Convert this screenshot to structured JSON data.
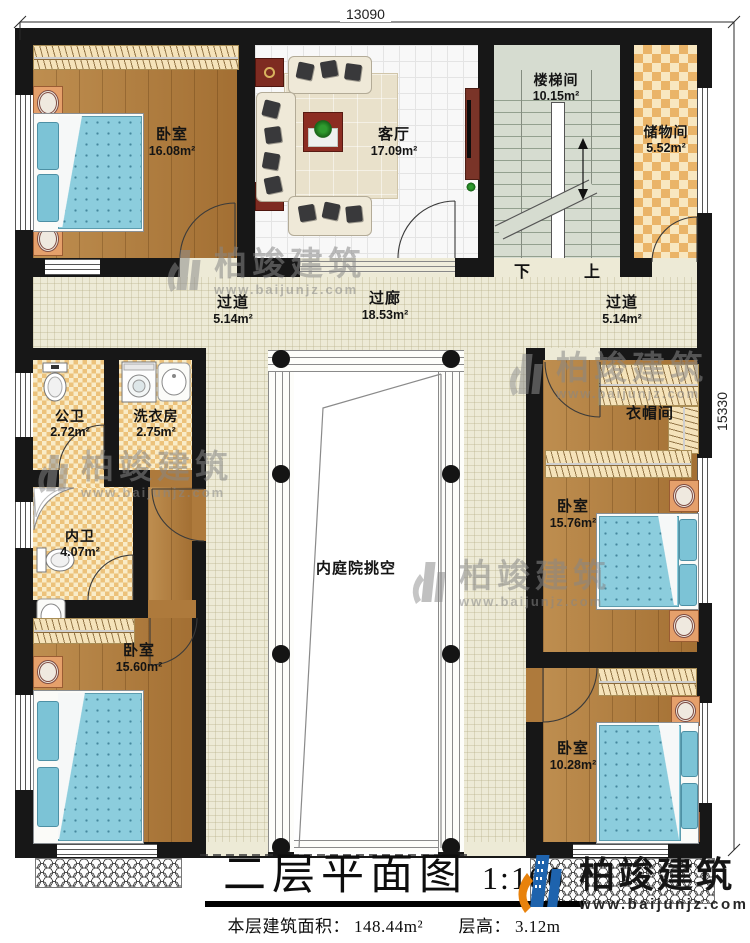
{
  "dimensions": {
    "top": "13090",
    "right": "15330"
  },
  "rooms": {
    "bedroom_tl": {
      "name": "卧室",
      "area": "16.08m²"
    },
    "living": {
      "name": "客厅",
      "area": "17.09m²"
    },
    "stairwell": {
      "name": "楼梯间",
      "area": "10.15m²"
    },
    "storage": {
      "name": "储物间",
      "area": "5.52m²"
    },
    "corridor_left": {
      "name": "过道",
      "area": "5.14m²"
    },
    "gallery": {
      "name": "过廊",
      "area": "18.53m²"
    },
    "corridor_right": {
      "name": "过道",
      "area": "5.14m²"
    },
    "public_bath": {
      "name": "公卫",
      "area": "2.72m²"
    },
    "laundry": {
      "name": "洗衣房",
      "area": "2.75m²"
    },
    "inner_bath": {
      "name": "内卫",
      "area": "4.07m²"
    },
    "bedroom_bl": {
      "name": "卧室",
      "area": "15.60m²"
    },
    "cloakroom": {
      "name": "衣帽间"
    },
    "bedroom_right": {
      "name": "卧室",
      "area": "15.76m²"
    },
    "bedroom_br": {
      "name": "卧室",
      "area": "10.28m²"
    },
    "courtyard": {
      "name": "内庭院挑空"
    }
  },
  "stairs": {
    "down": "下",
    "up": "上"
  },
  "title": {
    "main": "二层平面图",
    "scale": "1:100",
    "area_label": "本层建筑面积：",
    "area_value": "148.44m²",
    "height_label": "层高：",
    "height_value": "3.12m"
  },
  "brand": {
    "name": "柏竣建筑",
    "url": "www.baijunjz.com"
  },
  "watermark": {
    "name": "柏竣建筑",
    "url": "www.baijunjz.com"
  },
  "colors": {
    "wall": "#171717",
    "wood": "#b07c3c",
    "corridor": "#edead6",
    "stair": "#d6dcd0",
    "storage_checker": "#eab468",
    "bath_checker": "#ecc27b",
    "bed_blue": "#8ccddd",
    "brand_blue": "#1e63ad",
    "brand_orange": "#e8820c"
  }
}
